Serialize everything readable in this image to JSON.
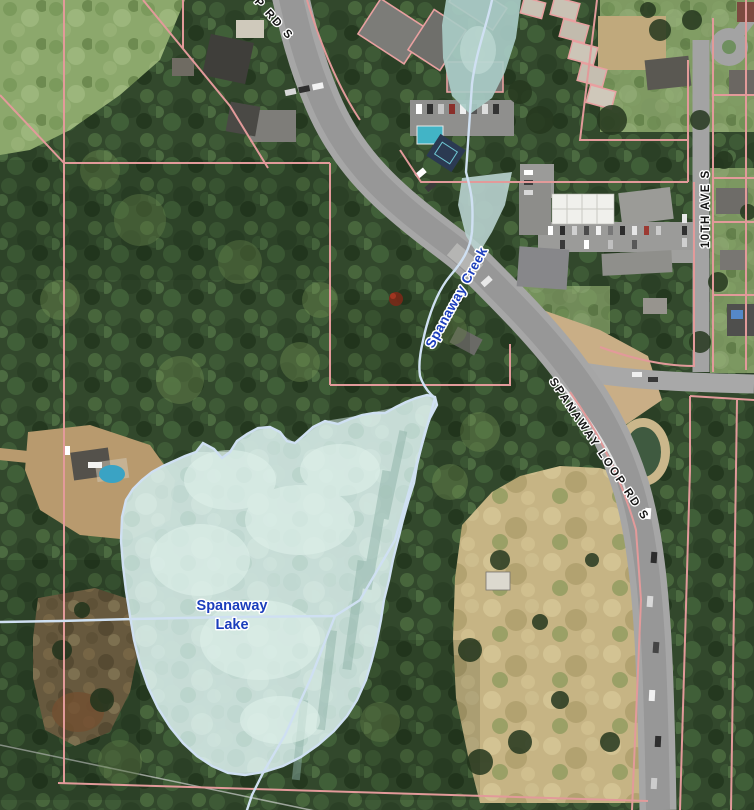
{
  "map": {
    "labels": {
      "lake_line1": "Spanaway",
      "lake_line2": "Lake",
      "creek": "Spanaway Creek",
      "loop_road": "SPANAWAY LOOP RD S",
      "avenue": "10TH AVE S",
      "top_road_partial": "P RD S"
    },
    "colors": {
      "parcel_line": "#e29a9a",
      "water_outline": "#cfe0f2",
      "lake_fill": "#c9dfda",
      "pond_fill": "#a8cbc6",
      "wetland_fill": "#b8d2cf",
      "water_label": "#1c3ebc",
      "road_label": "#141414",
      "label_halo": "#ffffff"
    }
  }
}
